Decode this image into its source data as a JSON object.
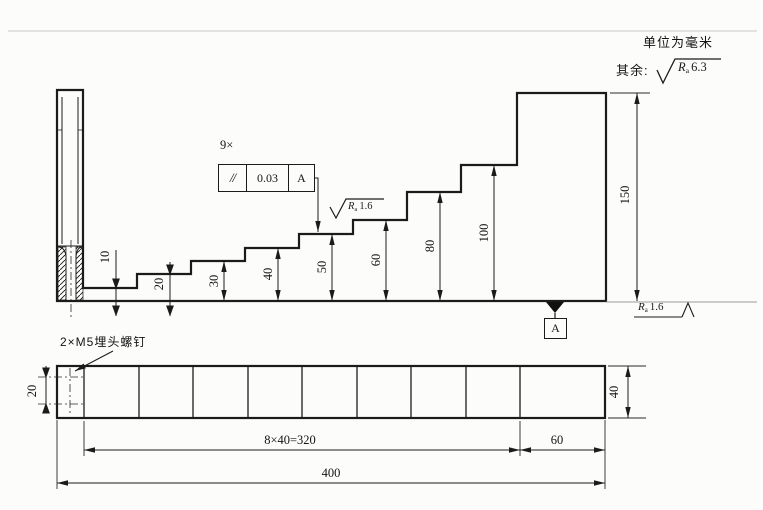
{
  "drawing": {
    "unit_note": "单位为毫米",
    "default_roughness": {
      "prefix": "其余:",
      "letter": "R",
      "sub": "a",
      "value": "6.3"
    },
    "tolerance_frame": {
      "count_note": "9×",
      "characteristic": "//",
      "value": "0.03",
      "datum_ref": "A"
    },
    "datum_label": "A",
    "step_roughness": {
      "letter": "R",
      "sub": "a",
      "value": "1.6"
    },
    "bottom_roughness": {
      "letter": "R",
      "sub": "a",
      "value": "1.6"
    },
    "side_view": {
      "height_dims": [
        "10",
        "20",
        "30",
        "40",
        "50",
        "60",
        "80",
        "100"
      ],
      "overall_height": "150"
    },
    "plan_view": {
      "screw_note": "2×M5埋头螺钉",
      "screw_spacing": "20",
      "step_pitch": "8×40=320",
      "end_segment": "60",
      "overall_length": "400",
      "width": "40"
    }
  }
}
